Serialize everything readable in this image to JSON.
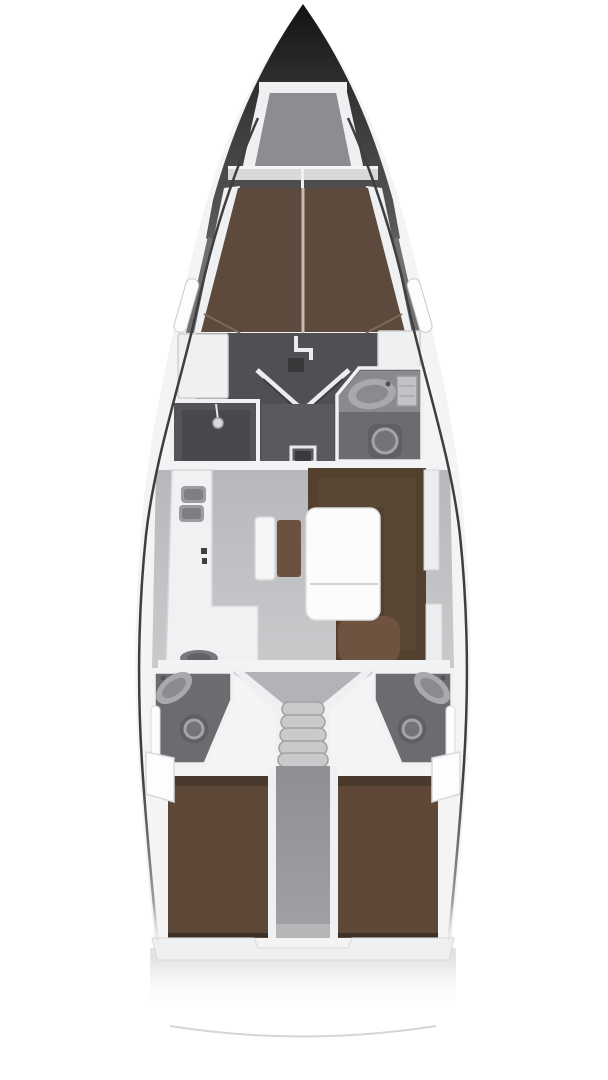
{
  "meta": {
    "type": "yacht-interior-floor-plan",
    "view": "top-down",
    "description": "Sailing yacht deck layout: forward V-berth cabin, shower room, forward head, salon with galley and U-settee dinette, companionway steps, twin aft heads, twin aft double cabins"
  },
  "colors": {
    "background": "#ffffff",
    "hull_line": "#3e3e40",
    "bow_tip": "#121212",
    "bow_mid": "#3a3a3c",
    "bow_base": "#626264",
    "hull_band": "#707073",
    "deck_white": "#f4f4f5",
    "trim_white": "#eef0f1",
    "panel_line": "#d2d3d5",
    "anchor_locker": "#8c8d91",
    "headboard": "#d8d9db",
    "bed_brown": "#5d4a3c",
    "bed_seam": "#d0cac3",
    "bed_foot": "#4e4034",
    "cabin_floor_dark": "#505054",
    "shower_room": "#545458",
    "shower_dark": "#49494d",
    "corridor_fwd": "#5a5a5e",
    "door_white": "#ececee",
    "hatch_dark": "#38383a",
    "head_room": "#6b6c70",
    "head_counter": "#898a8e",
    "fixture_light": "#a8a9ad",
    "fixture_inner": "#8a8b8f",
    "cabinet_gray": "#c2c3c7",
    "toilet_base": "#5f6064",
    "toilet_ring": "#a3a4a8",
    "toilet_inner": "#737478",
    "salon_floor": "#b7b8bb",
    "salon_floor_light": "#c9cacc",
    "galley_white": "#f1f1f3",
    "sink_gray": "#9b9ca0",
    "sink_inner": "#7e7f83",
    "stove_gray": "#77787c",
    "bench_white": "#f5f5f6",
    "cushion_brown": "#6a5140",
    "sofa_brown": "#53402f",
    "sofa_light": "#6d5340",
    "table_white": "#fcfcfc",
    "table_line": "#d2d3d5",
    "wardrobe_white": "#ecedef",
    "bulkhead_white": "#f2f3f4",
    "step_gray": "#c9cacc",
    "step_line": "#a0a1a4",
    "stair_floor": "#b2b3b6",
    "corridor_aft": "#8e8f92",
    "corridor_aft_light": "#b5b6b8",
    "aft_bed_left": "#5d4736",
    "aft_bed_right": "#5f4837",
    "bed_dark_edge": "#3c3027",
    "bed_head_shadow": "#4a3a2d",
    "transom_white": "#eff0f1",
    "stern_line": "#d0d1d2",
    "window_white": "#fdfdfe",
    "mark_dark": "#3f3f41"
  },
  "fixtures": {
    "bow": "anchor-locker",
    "forward_cabin": "v-berth-double-bed",
    "shower": "shower-room",
    "forward_head": "toilet-and-washbasin",
    "galley": "l-galley-twin-sinks-stove",
    "salon": "u-settee-with-table",
    "companionway": "entry-steps",
    "aft_head_port": "toilet-and-washbasin",
    "aft_head_starboard": "toilet-and-washbasin",
    "aft_cabin_port": "double-bed",
    "aft_cabin_starboard": "double-bed"
  }
}
